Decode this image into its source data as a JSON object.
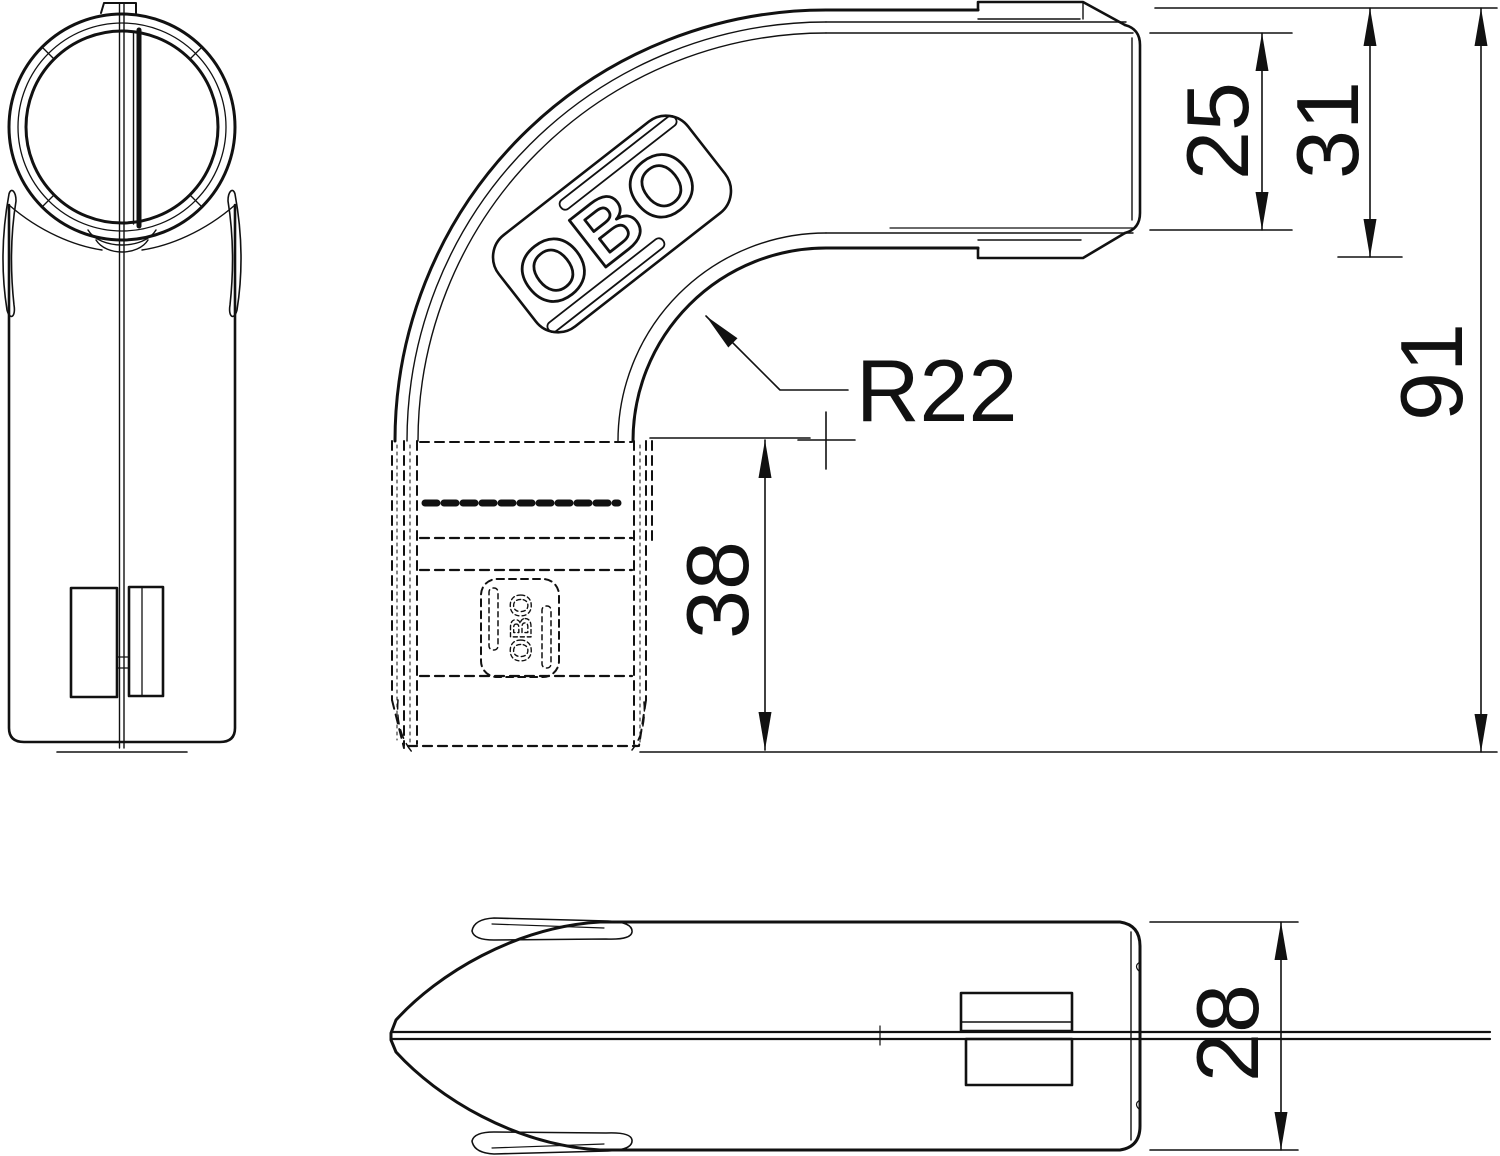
{
  "drawing": {
    "logo_text": "OBO",
    "hidden_logo_text": "OBO",
    "dimensions": {
      "opening_height": "25",
      "end_height": "31",
      "overall_height": "91",
      "socket_depth": "38",
      "body_depth": "28",
      "bend_radius": "R22"
    },
    "colors": {
      "line": "#111111",
      "background": "#ffffff"
    }
  }
}
